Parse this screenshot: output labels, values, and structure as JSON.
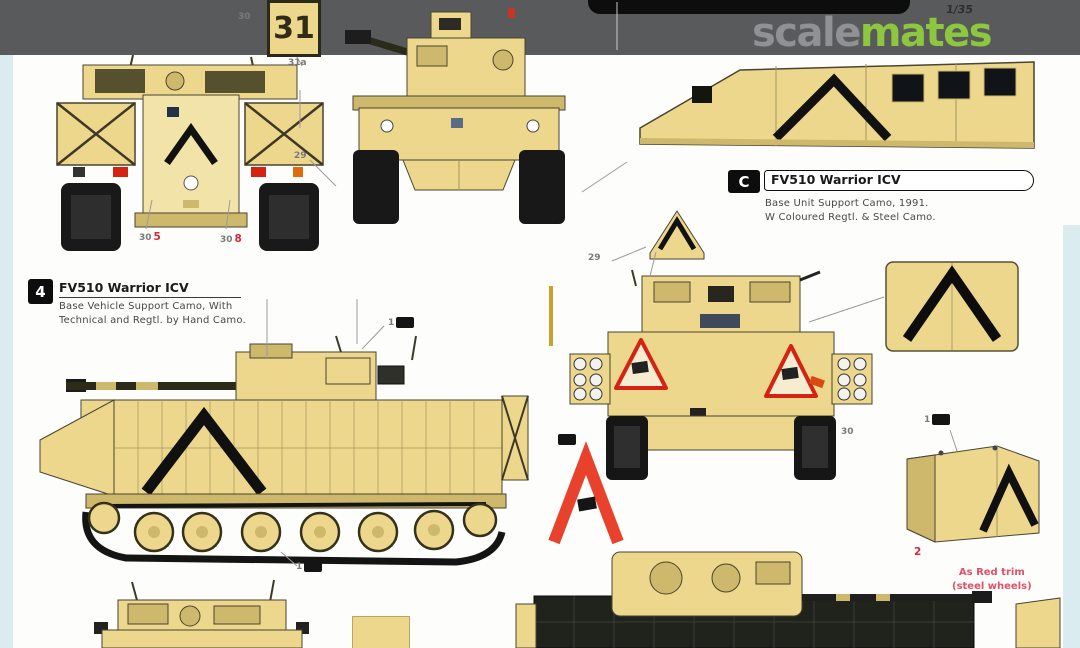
{
  "colors": {
    "topbar": "#595a5c",
    "tan": "#ecd78d",
    "tan_dark": "#cdb86b",
    "tan_light": "#f2e4a8",
    "outline": "#4a4430",
    "panel": "#a4965b",
    "ink": "#141414",
    "red": "#d42313",
    "red_chevron": "#e8422c",
    "red_text": "#e0506a",
    "orange": "#e06a10",
    "edge_blue": "#daecef",
    "wm_gray": "#909194",
    "wm_green": "#8dc63f",
    "pill": "#0d0d0d"
  },
  "topbar": {
    "scale_label": "1/35"
  },
  "watermark": {
    "part1": "scale",
    "part2": "mates"
  },
  "plate": {
    "number": "31"
  },
  "labels": {
    "left": {
      "marker": "4",
      "title": "FV510 Warrior ICV",
      "line1": "Base Vehicle Support Camo, With",
      "line2": "Technical and Regtl. by Hand Camo."
    },
    "right": {
      "marker": "C",
      "title": "FV510 Warrior ICV",
      "line1": "Base Unit Support Camo, 1991.",
      "line2": "W Coloured Regtl. & Steel Camo."
    }
  },
  "callouts": [
    {
      "num": "1"
    },
    {
      "num": "1"
    },
    {
      "num": "1"
    },
    {
      "num": "30"
    },
    {
      "num": "31a"
    },
    {
      "num": "30",
      "red": "5"
    },
    {
      "num": "30",
      "red": "8"
    },
    {
      "red": "2"
    },
    {
      "num": "29"
    },
    {
      "num": "30"
    },
    {
      "num": "29"
    },
    {}
  ],
  "red_note": {
    "line1": "As Red trim",
    "line2": "(steel wheels)"
  }
}
